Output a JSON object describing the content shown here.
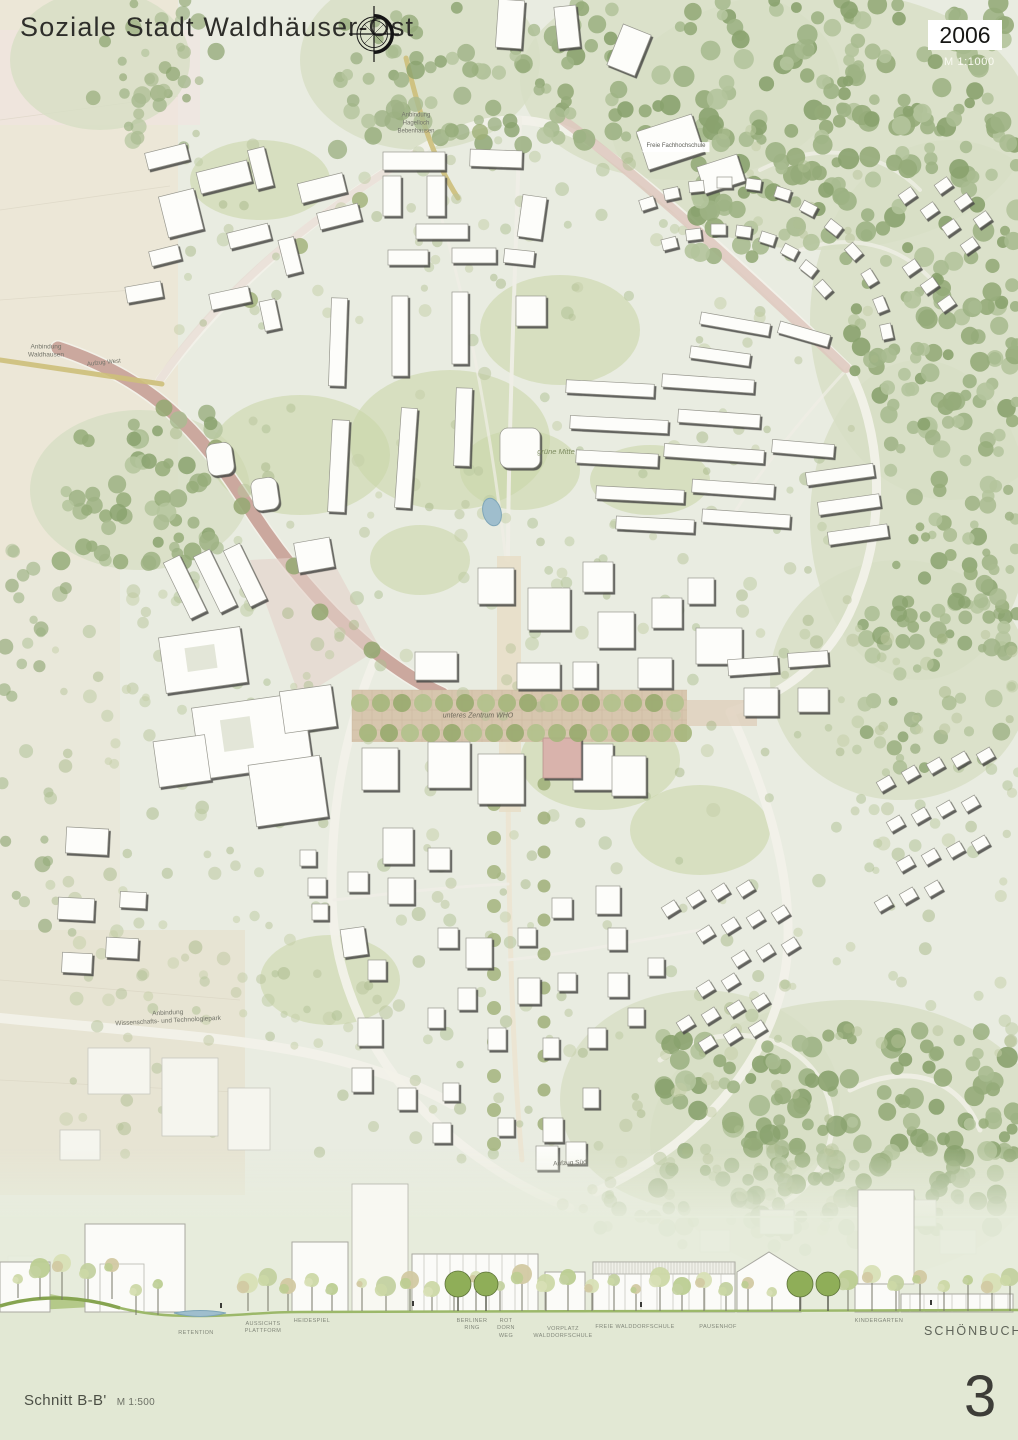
{
  "header": {
    "title": "Soziale Stadt Waldhäuser-Ost",
    "year": "2006",
    "scale": "M 1:1000"
  },
  "footer": {
    "section_title": "Schnitt B-B'",
    "section_scale": "M 1:500",
    "page_number": "3",
    "region_label": "SCHÖNBUCH"
  },
  "map": {
    "labels": [
      {
        "text": "Anbindung\nWaldhausen",
        "x": 46,
        "y": 352,
        "size": 6.5,
        "rot": 0
      },
      {
        "text": "Aufzug West",
        "x": 104,
        "y": 364,
        "size": 6,
        "rot": -6
      },
      {
        "text": "Anbindung\nHagelloch\nBebenhausen",
        "x": 416,
        "y": 124,
        "size": 6,
        "rot": 0
      },
      {
        "text": "Freie Fachhochschule",
        "x": 676,
        "y": 147,
        "size": 6,
        "rot": 0,
        "bg": true
      },
      {
        "text": "grüne Mitte",
        "x": 556,
        "y": 452,
        "size": 7.5,
        "rot": 0,
        "italic": true,
        "color": "#7e8c60"
      },
      {
        "text": "unteres Zentrum WHO",
        "x": 478,
        "y": 716,
        "size": 7,
        "rot": 0,
        "italic": true,
        "color": "#6d685a"
      },
      {
        "text": "Aufzug Süd",
        "x": 570,
        "y": 1164,
        "size": 6.5,
        "rot": -3
      },
      {
        "text": "Anbindung\nWissenschafts- und Technologiepark",
        "x": 168,
        "y": 1018,
        "size": 6.5,
        "rot": -3
      }
    ]
  },
  "section": {
    "labels": [
      {
        "text": "RETENTION",
        "x": 196,
        "y": 1330
      },
      {
        "text": "AUSSICHTS\nPLATTFORM",
        "x": 263,
        "y": 1321
      },
      {
        "text": "HEIDESPIEL",
        "x": 312,
        "y": 1318
      },
      {
        "text": "BERLINER\nRING",
        "x": 472,
        "y": 1318
      },
      {
        "text": "ROT\nDORN\nWEG",
        "x": 506,
        "y": 1318
      },
      {
        "text": "VORPLATZ\nWALDDORFSCHULE",
        "x": 563,
        "y": 1326
      },
      {
        "text": "FREIE WALDDORFSCHULE",
        "x": 635,
        "y": 1324
      },
      {
        "text": "PAUSENHOF",
        "x": 718,
        "y": 1324
      },
      {
        "text": "KINDERGARTEN",
        "x": 879,
        "y": 1318
      }
    ]
  },
  "colors": {
    "base": "#e9ece1",
    "field": "#ece7d7",
    "field2": "#e7e4d3",
    "pinkwash": "#f2e3e1",
    "forest_under": "#d7dfc4",
    "lawn": "#c9d5a5",
    "road": "#f2f1e9",
    "red_road": "#c6a096",
    "pink_road": "#ddc5bc",
    "ochre_road": "#cdbf7a",
    "plaza": "#d7c6ae",
    "plaza_grid": "#c6b297",
    "paving": "#e5d2c9",
    "building": "#fdfdfa",
    "building_stroke": "#97978e",
    "shadow": "#4c4c46",
    "building_faint": "#f5f5ee",
    "building_pale": "#f8f8f2",
    "pink_building": "#d9b3ac",
    "water": "#9fbecd",
    "water_edge": "#7fa6b8",
    "ground": "#e2e8d4",
    "grass": "#9cb86a",
    "grass_dark": "#86a450",
    "tree_forest": [
      "#9db284",
      "#8aa26e",
      "#a9bb90",
      "#b4c49c",
      "#95ab79"
    ],
    "tree_light": [
      "#b7c49a",
      "#a7b888",
      "#c3cea6",
      "#aebf92",
      "#bcc9a0"
    ],
    "tree_row": "#9fb077",
    "tree_dark": "#8fae58",
    "section_canopy": [
      "#ccd8a6",
      "#bccd92",
      "#d8e0b6",
      "#c3d1a0",
      "#d2c9a2"
    ]
  }
}
